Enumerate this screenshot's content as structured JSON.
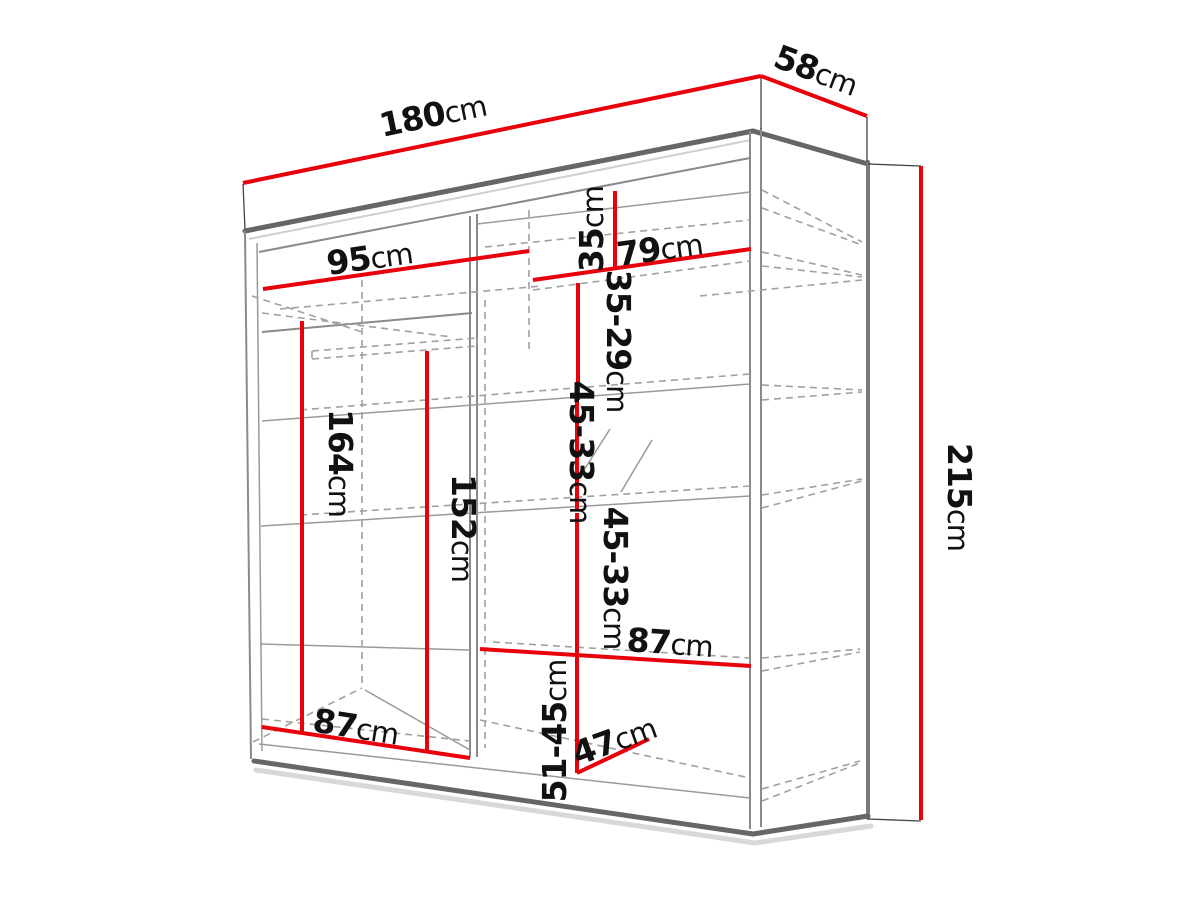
{
  "diagram": {
    "subject": "wardrobe-dimension-diagram",
    "unit": "cm",
    "dims": {
      "d180": {
        "num": "180",
        "unit": "cm"
      },
      "d58": {
        "num": "58",
        "unit": "cm"
      },
      "d215": {
        "num": "215",
        "unit": "cm"
      },
      "d95": {
        "num": "95",
        "unit": "cm"
      },
      "d79": {
        "num": "79",
        "unit": "cm"
      },
      "d35": {
        "num": "35",
        "unit": "cm"
      },
      "d35_29": {
        "num": "35-29",
        "unit": "cm"
      },
      "d45_33a": {
        "num": "45-33",
        "unit": "cm"
      },
      "d45_33b": {
        "num": "45-33",
        "unit": "cm"
      },
      "d164": {
        "num": "164",
        "unit": "cm"
      },
      "d152": {
        "num": "152",
        "unit": "cm"
      },
      "d87_right": {
        "num": "87",
        "unit": "cm"
      },
      "d51_45": {
        "num": "51-45",
        "unit": "cm"
      },
      "d47": {
        "num": "47",
        "unit": "cm"
      },
      "d87_left": {
        "num": "87",
        "unit": "cm"
      }
    },
    "colors": {
      "dimension_line": "#e8000a",
      "structure_dark": "#666666",
      "structure_light": "#a0a0a0",
      "label_text": "#111111",
      "background": "#ffffff"
    }
  }
}
